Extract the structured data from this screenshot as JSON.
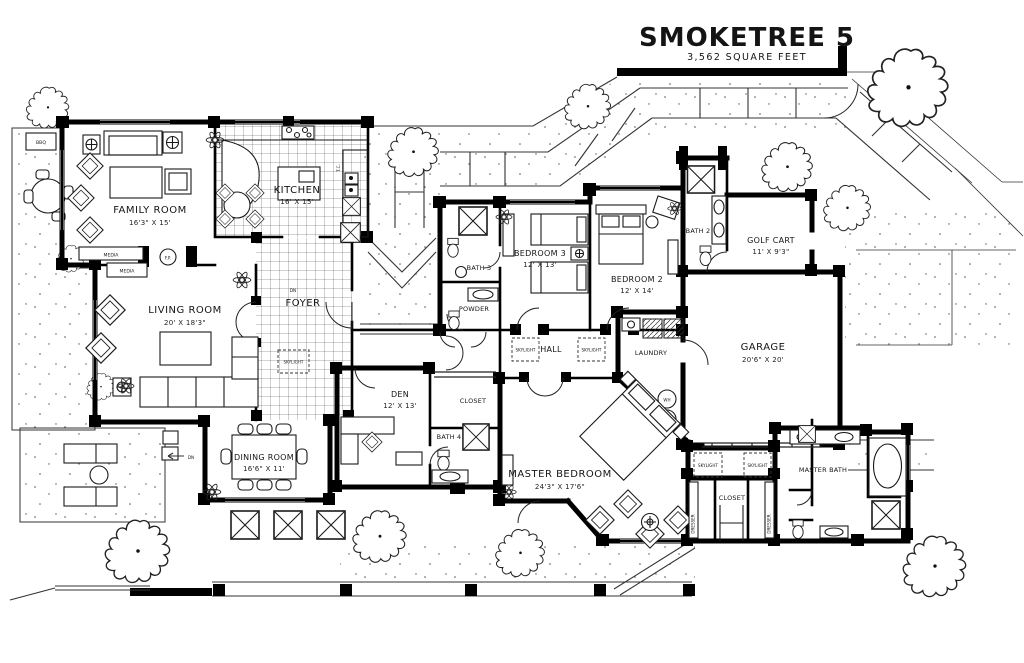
{
  "title": {
    "name": "SMOKETREE 5",
    "area": "3,562 SQUARE FEET"
  },
  "rooms": {
    "family": {
      "label": "FAMILY ROOM",
      "dims": "16'3\" X 15'"
    },
    "kitchen": {
      "label": "KITCHEN",
      "dims": "16' X 15'"
    },
    "living": {
      "label": "LIVING ROOM",
      "dims": "20' X 18'3\""
    },
    "foyer": {
      "label": "FOYER"
    },
    "dining": {
      "label": "DINING ROOM",
      "dims": "16'6\" X 11'"
    },
    "den": {
      "label": "DEN",
      "dims": "12' X 13'"
    },
    "bedroom3": {
      "label": "BEDROOM 3",
      "dims": "12' X 13'"
    },
    "bedroom2": {
      "label": "BEDROOM 2",
      "dims": "12' X 14'"
    },
    "bath2": {
      "label": "BATH 2"
    },
    "bath3": {
      "label": "BATH 3"
    },
    "bath4": {
      "label": "BATH 4"
    },
    "powder": {
      "label": "POWDER"
    },
    "hall": {
      "label": "HALL"
    },
    "laundry": {
      "label": "LAUNDRY"
    },
    "golfcart": {
      "label": "GOLF CART",
      "dims": "11' X 9'3\""
    },
    "garage": {
      "label": "GARAGE",
      "dims": "20'6\" X 20'"
    },
    "master": {
      "label": "MASTER BEDROOM",
      "dims": "24'3\" X 17'6\""
    },
    "masterbath": {
      "label": "MASTER BATH"
    },
    "mastercloset": {
      "label": "CLOSET"
    },
    "dencloset": {
      "label": "CLOSET"
    }
  },
  "annotations": {
    "skylight": "SKYLIGHT",
    "media": "MEDIA",
    "bbq": "BBQ",
    "fp": "F.P.",
    "wh": "WH",
    "dn": "DN",
    "dresser": "DRESSER",
    "tc": "T.C."
  }
}
